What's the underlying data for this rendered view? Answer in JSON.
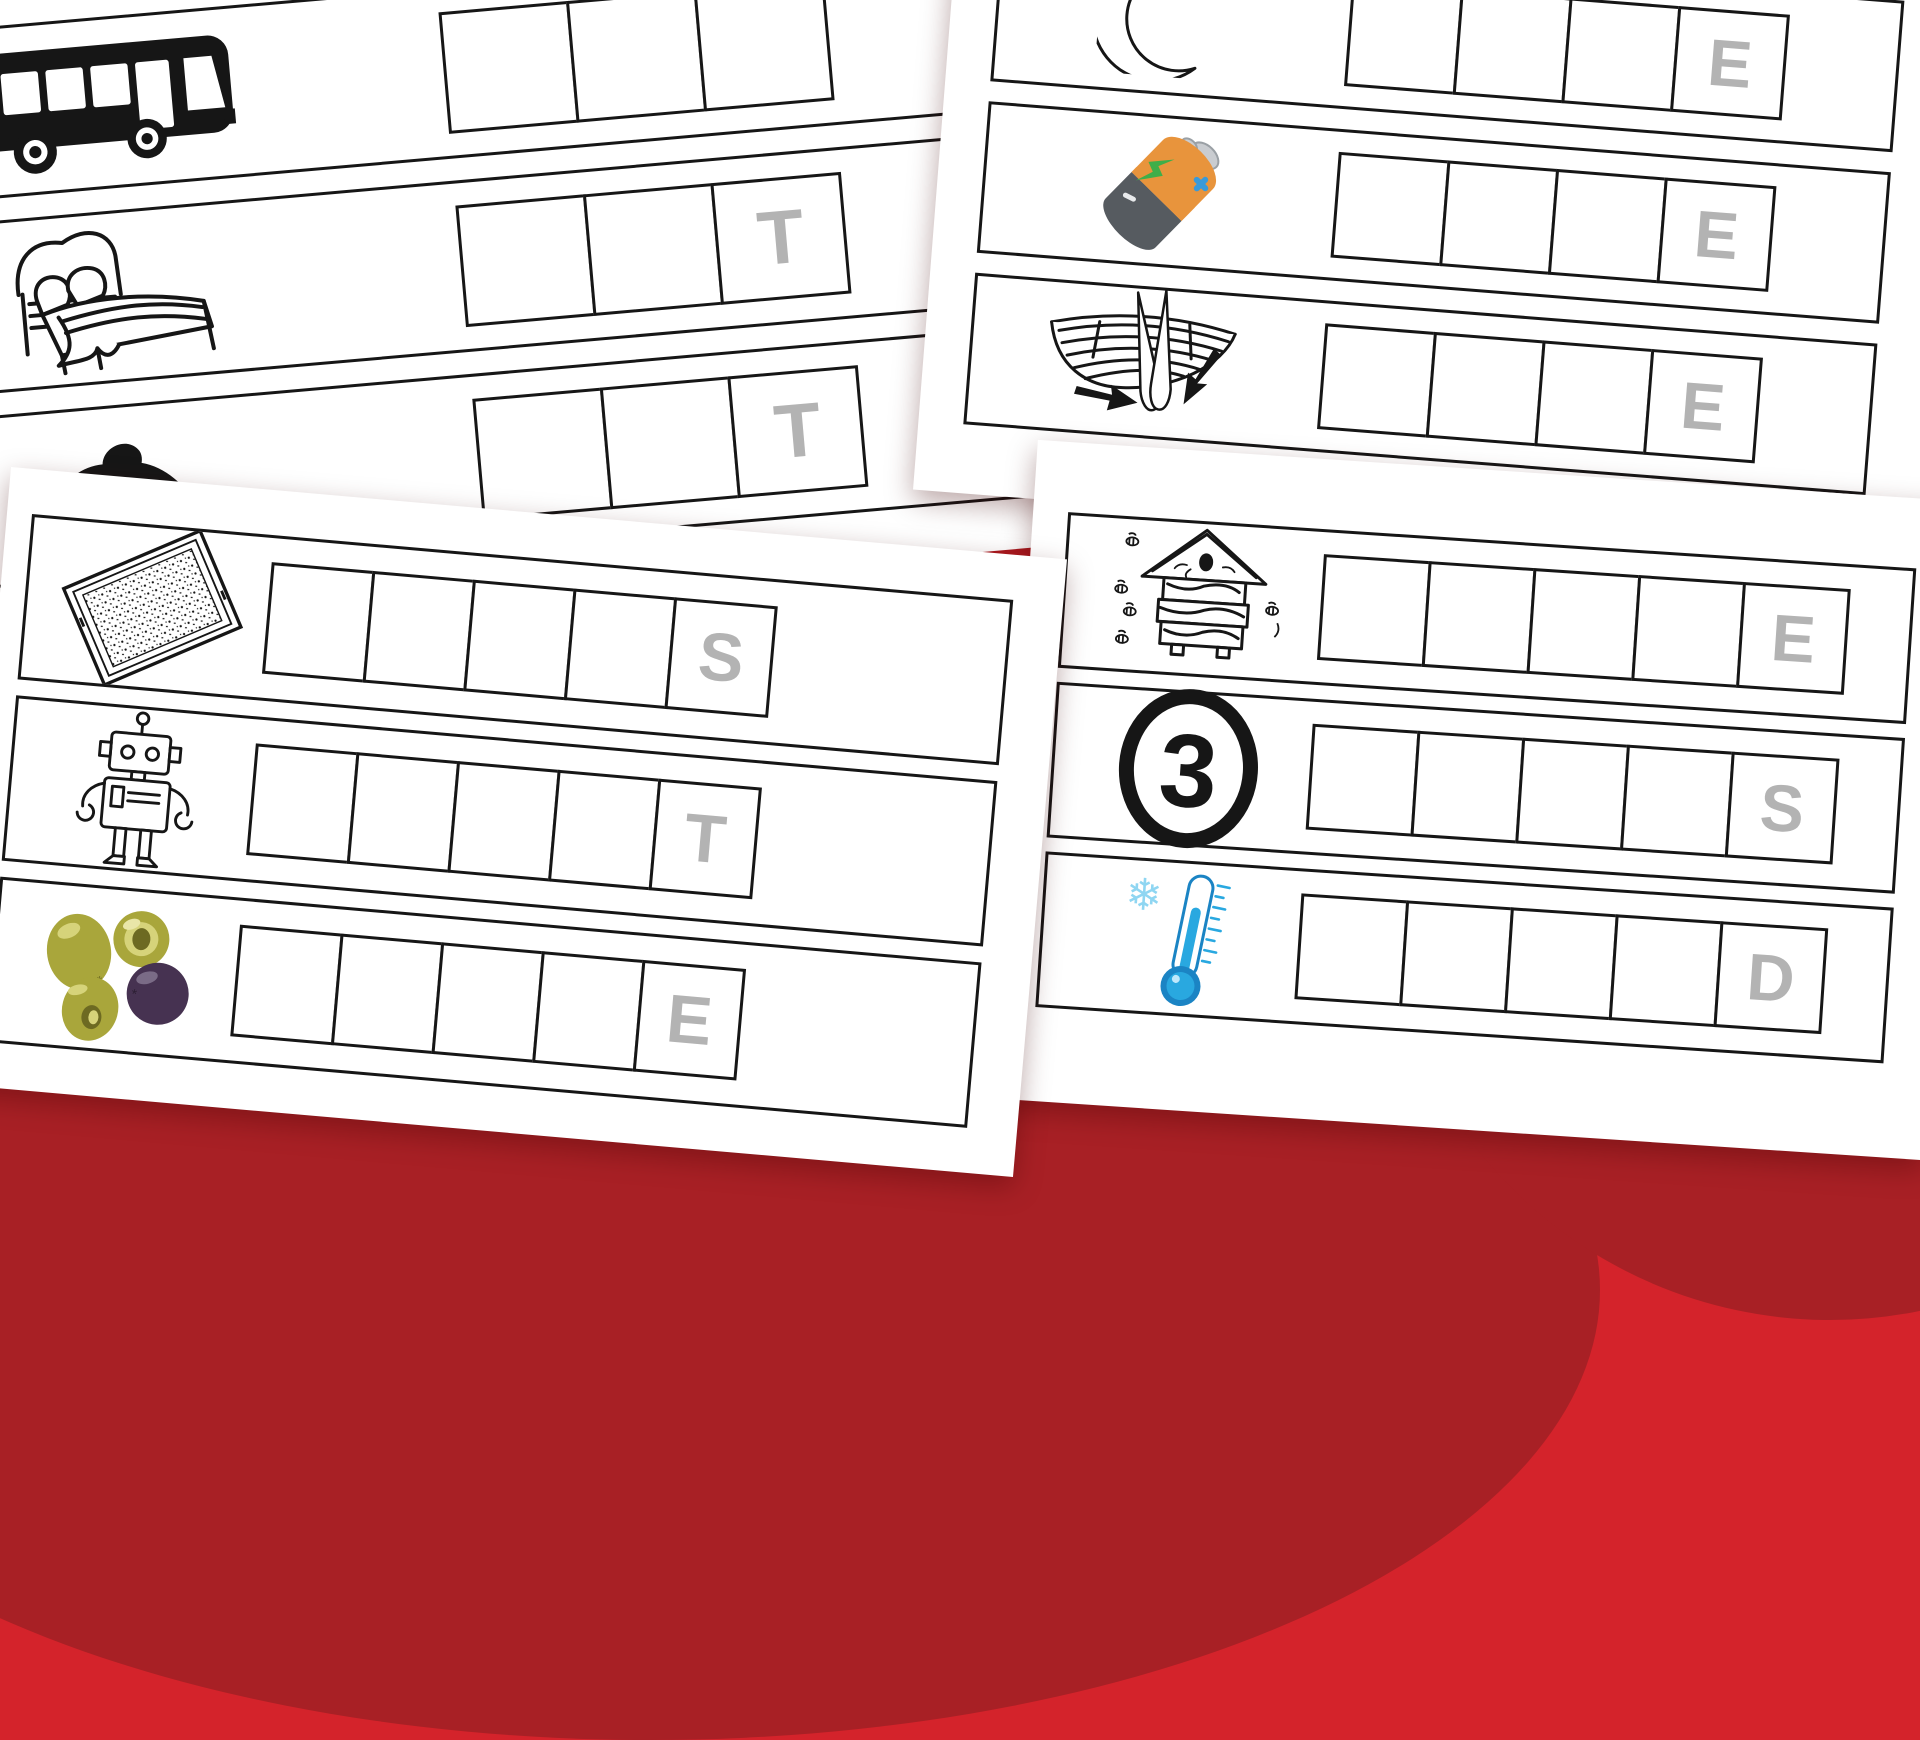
{
  "colors": {
    "background_red": "#d4232b",
    "swirl_dark_red": "#a82025",
    "ink_black": "#161616",
    "hint_letter_gray": "#b3b3b3",
    "battery_orange": "#e8943c",
    "battery_gray": "#565b60",
    "battery_bolt_green": "#3fae49",
    "battery_spark_blue": "#3a9ad9",
    "battery_cap_silver": "#c9ccd0",
    "olive_green": "#a9a63b",
    "olive_green_light": "#d6d37a",
    "olive_pit_dark": "#6d6a22",
    "olive_purple": "#463251",
    "thermometer_blue": "#29a8e0",
    "thermometer_deep_blue": "#1b84c4",
    "snowflake_blue": "#8fd6f2"
  },
  "sheets": [
    {
      "name": "top-left-sheet",
      "items": [
        {
          "word_image": "bus",
          "icon": "bus-icon",
          "boxes": 3,
          "hint": ""
        },
        {
          "word_image": "bed",
          "icon": "bed-icon",
          "boxes": 3,
          "hint": "T"
        },
        {
          "word_image": "rat",
          "icon": "rat-icon",
          "boxes": 3,
          "hint": "T"
        }
      ]
    },
    {
      "name": "top-right-sheet",
      "items": [
        {
          "word_image": "crescent-moon",
          "icon": "moon-icon",
          "boxes": 4,
          "hint": "E"
        },
        {
          "word_image": "battery",
          "icon": "battery-icon",
          "boxes": 4,
          "hint": "E"
        },
        {
          "word_image": "boat-oars",
          "icon": "oars-icon",
          "boxes": 4,
          "hint": "E"
        }
      ]
    },
    {
      "name": "bottom-left-sheet",
      "items": [
        {
          "word_image": "mat",
          "icon": "mat-icon",
          "boxes": 5,
          "hint": "S"
        },
        {
          "word_image": "robot",
          "icon": "robot-icon",
          "boxes": 5,
          "hint": "T"
        },
        {
          "word_image": "olives",
          "icon": "olives-icon",
          "boxes": 5,
          "hint": "E"
        }
      ]
    },
    {
      "name": "bottom-right-sheet",
      "items": [
        {
          "word_image": "beehive",
          "icon": "beehive-icon",
          "boxes": 5,
          "hint": "E"
        },
        {
          "word_image": "number-three",
          "icon": "three-icon",
          "boxes": 5,
          "hint": "S"
        },
        {
          "word_image": "cold-thermometer",
          "icon": "thermometer-icon",
          "boxes": 5,
          "hint": "D"
        }
      ]
    }
  ],
  "number_three_label": "3"
}
